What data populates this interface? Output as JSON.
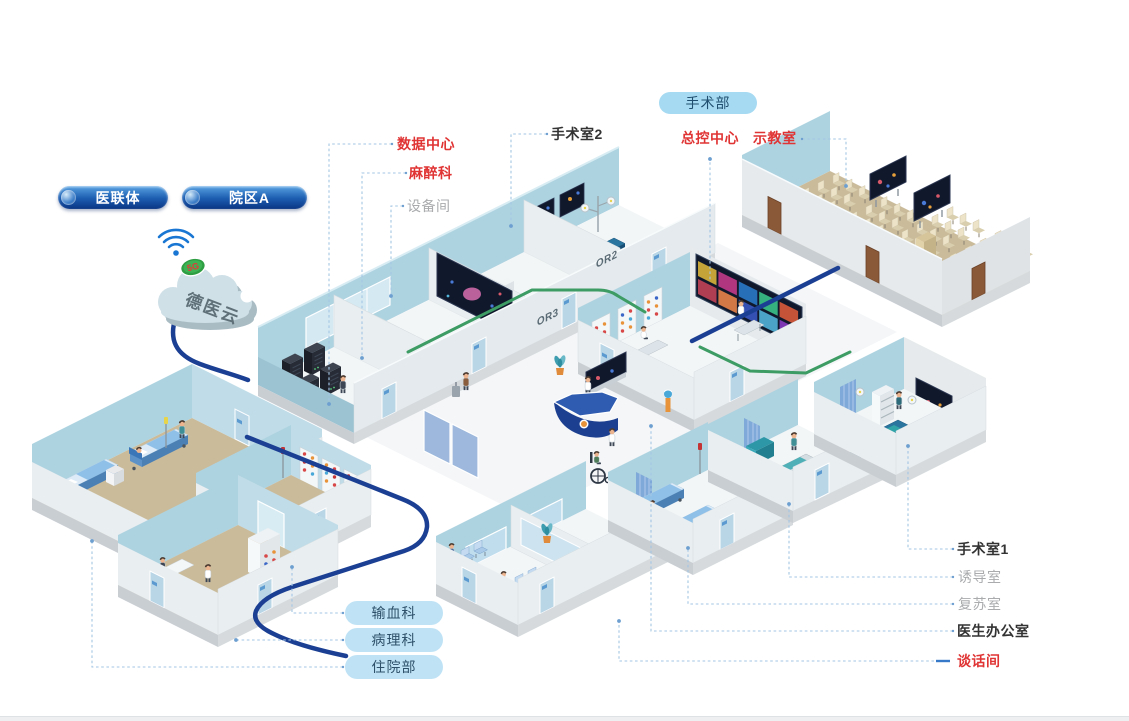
{
  "legend": {
    "alliance": "医联体",
    "campus": "院区A"
  },
  "cloud": {
    "label": "德医云",
    "badge": "5G"
  },
  "department_pill": "手术部",
  "room_labels": {
    "data_center": "数据中心",
    "anesthesiology": "麻醉科",
    "equipment_room": "设备间",
    "operating_room_2": "手术室2",
    "master_control_center": "总控中心",
    "demo_classroom": "示教室",
    "operating_room_1": "手术室1",
    "induction_room": "诱导室",
    "recovery_room": "复苏室",
    "doctor_office": "医生办公室",
    "talk_room": "谈话间"
  },
  "department_pills": {
    "blood_transfusion": "输血科",
    "pathology": "病理科",
    "inpatient": "住院部"
  },
  "wall_signs": {
    "or2": "OR2",
    "or3": "OR3"
  },
  "colors": {
    "label_red": "#e03434",
    "label_dark": "#333333",
    "label_gray": "#a9abad",
    "cable_blue": "#1b3f93",
    "cable_green": "#3d9c64",
    "leader": "#a3c6e4",
    "wall_blue": "#aed3e0",
    "floor_tan": "#cabb9b",
    "pill_light": "#bfe3f5",
    "pill_department": "#a6daf2",
    "pill_dark_top": "#57a2e2",
    "pill_dark_bottom": "#0a3584",
    "wifi_blue": "#1976d2",
    "badge_green": "#2f9e43"
  }
}
